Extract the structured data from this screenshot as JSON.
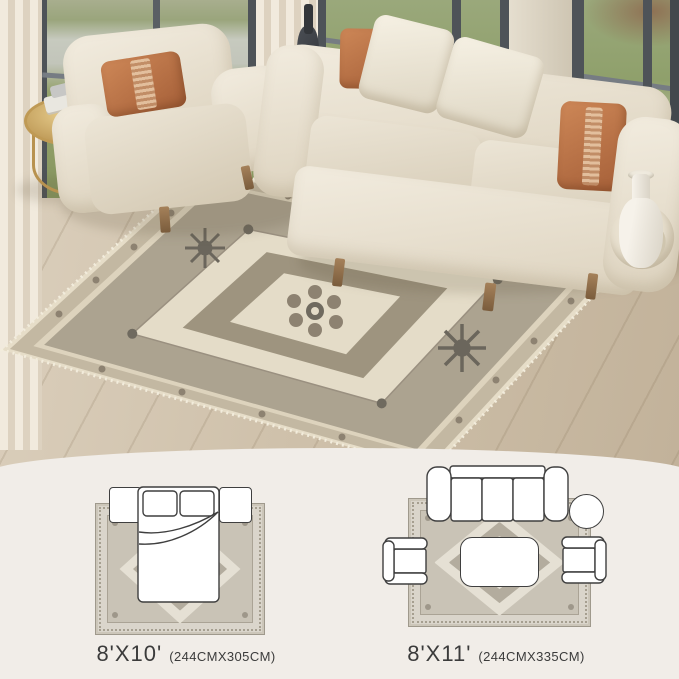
{
  "size_options": [
    {
      "size_label": "8'X10'",
      "dimensions_label": "(244CMX305CM)",
      "room_type": "bedroom",
      "furniture_icons": [
        "area-rug",
        "double-bed",
        "pillow",
        "pillow",
        "nightstand-left",
        "nightstand-right"
      ]
    },
    {
      "size_label": "8'X11'",
      "dimensions_label": "(244CMX335CM)",
      "room_type": "living-room",
      "furniture_icons": [
        "area-rug",
        "three-seat-sofa",
        "round-side-table",
        "armchair-left",
        "armchair-right",
        "coffee-table"
      ]
    }
  ],
  "photo_elements": [
    "sheer-curtains",
    "floor-to-ceiling-windows",
    "green-lawn",
    "cream-armchair",
    "rust-lumbar-pillow",
    "gold-round-side-table",
    "stacked-books",
    "black-bottle-vase",
    "cream-three-seat-sofa",
    "white-throw-pillows",
    "rust-throw-pillows",
    "white-floor-vase",
    "vintage-medallion-area-rug",
    "light-wood-floor"
  ],
  "colors": {
    "panel_background": "#f1ede8",
    "caption_text": "#3b3b3b",
    "diagram_outline": "#3f3f3f",
    "rug_field": "#aca390",
    "rug_cream": "#e4dcc8",
    "accent_rust": "#b97149",
    "sofa_cream": "#ece5d6",
    "wood_floor": "#cdbfa9",
    "grass_green": "#8fa06b",
    "brass_gold": "#bf9a55",
    "window_frame": "#4e5358"
  }
}
